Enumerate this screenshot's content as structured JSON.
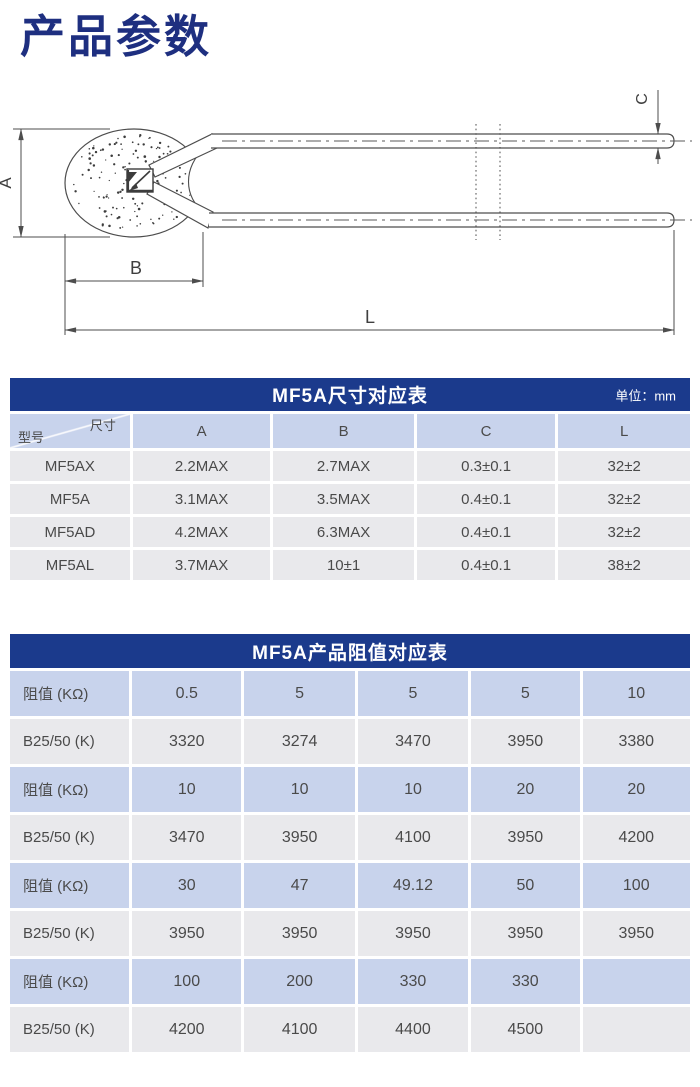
{
  "page": {
    "title": "产品参数"
  },
  "diagram": {
    "labels": {
      "a": "A",
      "b": "B",
      "c": "C",
      "l": "L"
    }
  },
  "dim_table": {
    "title": "MF5A尺寸对应表",
    "unit": "单位：mm",
    "corner_top": "尺寸",
    "corner_bottom": "型号",
    "columns": [
      "A",
      "B",
      "C",
      "L"
    ],
    "rows": [
      {
        "model": "MF5AX",
        "a": "2.2MAX",
        "b": "2.7MAX",
        "c": "0.3±0.1",
        "l": "32±2"
      },
      {
        "model": "MF5A",
        "a": "3.1MAX",
        "b": "3.5MAX",
        "c": "0.4±0.1",
        "l": "32±2"
      },
      {
        "model": "MF5AD",
        "a": "4.2MAX",
        "b": "6.3MAX",
        "c": "0.4±0.1",
        "l": "32±2"
      },
      {
        "model": "MF5AL",
        "a": "3.7MAX",
        "b": "10±1",
        "c": "0.4±0.1",
        "l": "38±2"
      }
    ]
  },
  "res_table": {
    "title": "MF5A产品阻值对应表",
    "rows": [
      {
        "label": "阻值 (KΩ)",
        "values": [
          "0.5",
          "5",
          "5",
          "5",
          "10"
        ]
      },
      {
        "label": "B25/50 (K)",
        "values": [
          "3320",
          "3274",
          "3470",
          "3950",
          "3380"
        ]
      },
      {
        "label": "阻值 (KΩ)",
        "values": [
          "10",
          "10",
          "10",
          "20",
          "20"
        ]
      },
      {
        "label": "B25/50 (K)",
        "values": [
          "3470",
          "3950",
          "4100",
          "3950",
          "4200"
        ]
      },
      {
        "label": "阻值 (KΩ)",
        "values": [
          "30",
          "47",
          "49.12",
          "50",
          "100"
        ]
      },
      {
        "label": "B25/50 (K)",
        "values": [
          "3950",
          "3950",
          "3950",
          "3950",
          "3950"
        ]
      },
      {
        "label": "阻值 (KΩ)",
        "values": [
          "100",
          "200",
          "330",
          "330",
          ""
        ]
      },
      {
        "label": "B25/50 (K)",
        "values": [
          "4200",
          "4100",
          "4400",
          "4500",
          ""
        ]
      }
    ]
  },
  "colors": {
    "header_navy": "#1b3a8c",
    "row_blue": "#c8d3ec",
    "row_gray": "#e9e9ec",
    "title_navy": "#1e2f80",
    "text_dark": "#4a4a4a"
  }
}
